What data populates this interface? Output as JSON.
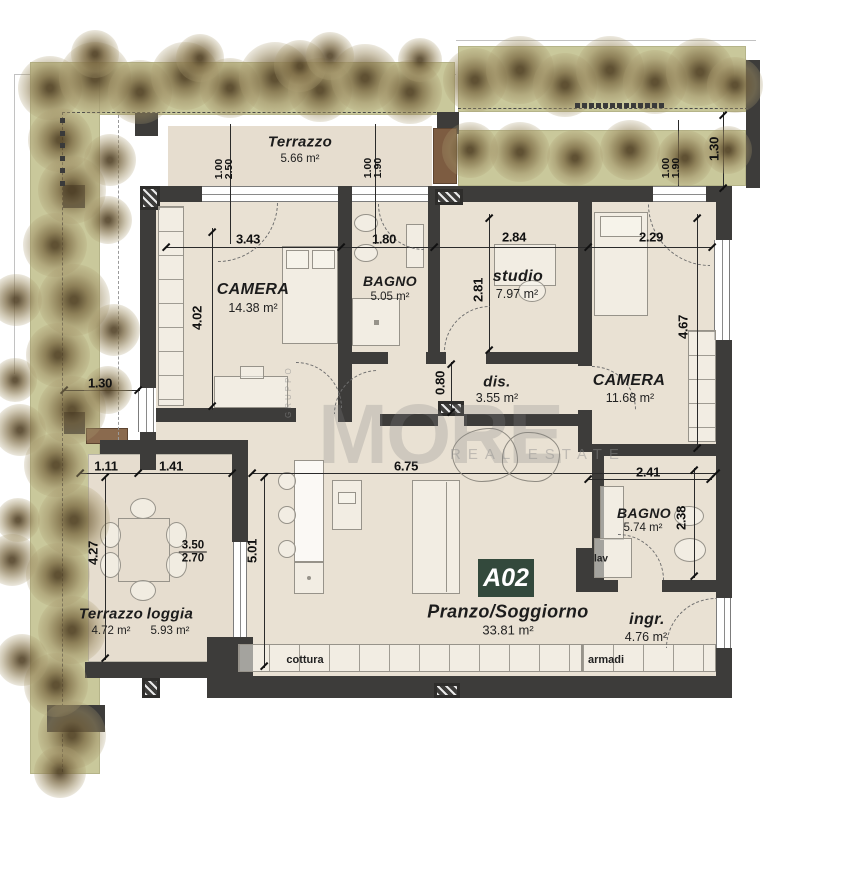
{
  "plan": {
    "badge": "A02",
    "watermark": {
      "brand": "MORE",
      "tagline": "REAL ESTATE",
      "vertical": "GRUPPO"
    },
    "rooms": {
      "terrazzo_top": {
        "name": "Terrazzo",
        "area": "5.66 m²"
      },
      "camera1": {
        "name": "CAMERA",
        "area": "14.38 m²"
      },
      "bagno1": {
        "name": "BAGNO",
        "area": "5.05 m²"
      },
      "studio": {
        "name": "studio",
        "area": "7.97 m²"
      },
      "camera2": {
        "name": "CAMERA",
        "area": "11.68 m²"
      },
      "dis": {
        "name": "dis.",
        "area": "3.55 m²"
      },
      "soggiorno": {
        "name": "Pranzo/Soggiorno",
        "area": "33.81 m²"
      },
      "bagno2": {
        "name": "BAGNO",
        "area": "5.74 m²"
      },
      "ingresso": {
        "name": "ingr.",
        "area": "4.76 m²"
      },
      "terrazzo_loggia_left": {
        "name": "Terrazzo",
        "area": "4.72 m²"
      },
      "terrazzo_loggia_right": {
        "name": "loggia",
        "area": "5.93 m²"
      }
    },
    "labels": {
      "lav": "lav",
      "cottura": "cottura",
      "armadi": "armadi"
    },
    "dims": {
      "w_camera1": "3.43",
      "w_bagno1": "1.80",
      "w_studio": "2.84",
      "w_camera2": "2.29",
      "h_camera1": "4.02",
      "h_studio": "2.81",
      "h_camera2": "4.67",
      "h_pass": "0.80",
      "w_loggia_a": "1.11",
      "w_loggia_b": "1.41",
      "h_loggia": "4.27",
      "h_living": "5.01",
      "w_living": "6.75",
      "w_bagno2": "2.41",
      "h_bagno2": "2.38",
      "frac_top": "3.50",
      "frac_bottom": "2.70",
      "garden_left": "1.30",
      "garden_right": "1.30",
      "win1_a": "1.00",
      "win1_b": "2.50",
      "win2_a": "1.00",
      "win2_b": "1.90",
      "win3_a": "1.00",
      "win3_b": "1.90"
    },
    "colors": {
      "wall": "#3d3c3a",
      "floor": "#e9e1d3",
      "garden": "#c9c89b",
      "badge": "#33493c"
    }
  }
}
